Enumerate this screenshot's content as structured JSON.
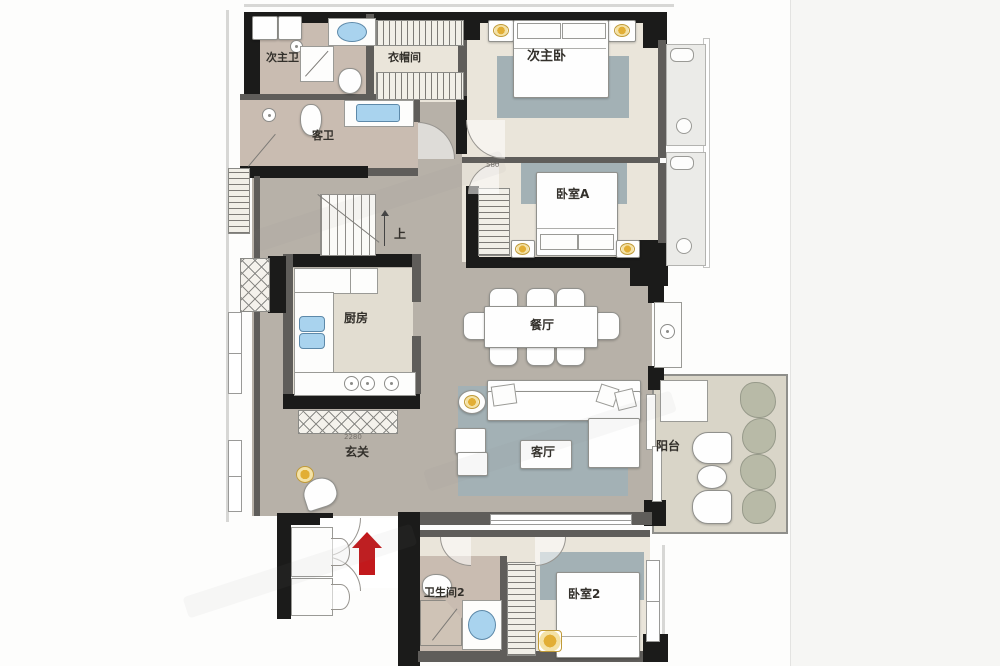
{
  "meta": {
    "type": "floor-plan",
    "language": "zh-CN"
  },
  "labels": {
    "ci_zhu_wei": "次主卫",
    "ke_wei": "客卫",
    "yi_mao_jian": "衣帽间",
    "ci_zhu_wo": "次主卧",
    "wo_shi_a": "卧室A",
    "can_ting": "餐厅",
    "chu_fang": "厨房",
    "shang": "上",
    "xuan_guan": "玄关",
    "ke_ting": "客厅",
    "yang_tai": "阳台",
    "wei_sheng_jian_2": "卫生间2",
    "wo_shi_2": "卧室2"
  },
  "dimensions": {
    "bedroom_a_door": "580",
    "entry_width": "2280"
  },
  "colors": {
    "wall": "#1b1b1a",
    "hall_floor": "#b7b1a8",
    "room_floor": "#eae5da",
    "bath_floor": "#c9bcb1",
    "rug": "#a3b1b5",
    "balcony_floor": "#d9d5c8",
    "entrance_arrow_red": "#c2191c",
    "lamp_yellow": "#e2ae35",
    "sink_blue": "#a9d3ee"
  },
  "annotations": {
    "entrance_arrow": "entrance",
    "stair_direction": "up"
  }
}
